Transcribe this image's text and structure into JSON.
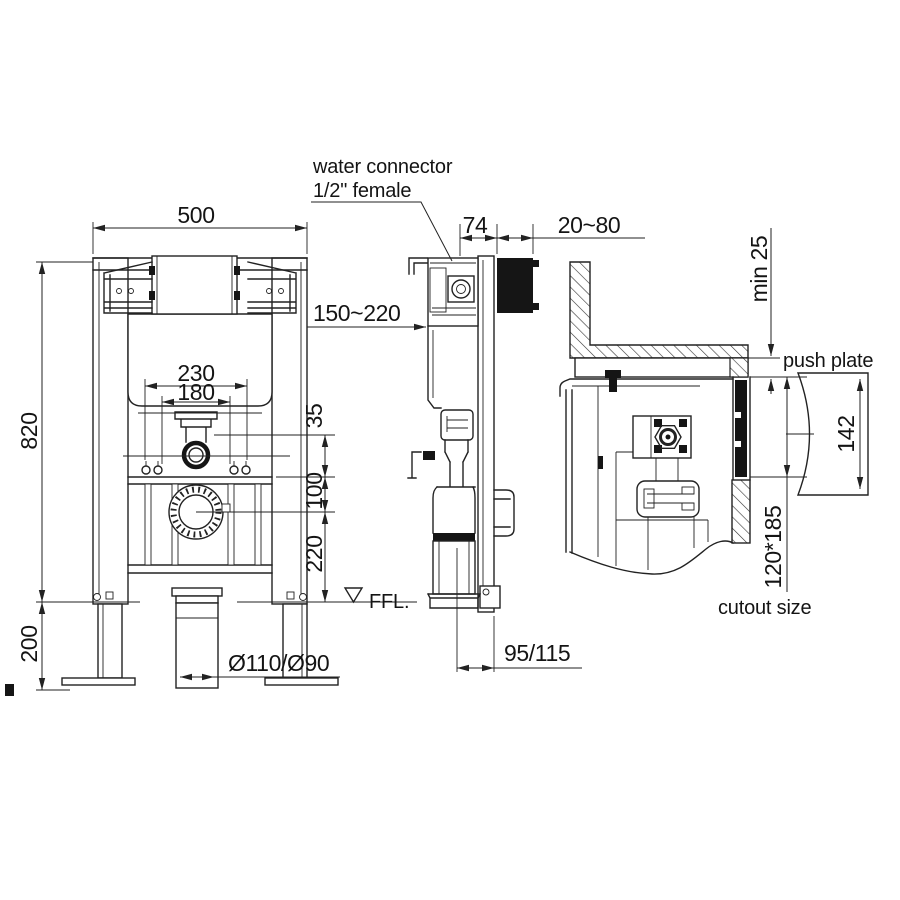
{
  "drawing": {
    "type": "technical-installation-diagram",
    "subject": "concealed cistern wc frame, three views with dimensions",
    "colors": {
      "line": "#222222",
      "background": "#ffffff",
      "solid_fill": "#151515"
    },
    "labels": {
      "water_connector_line1": "water connector",
      "water_connector_line2": "1/2\" female",
      "push_plate": "push plate",
      "cutout_size": "cutout size",
      "ffl": "FFL."
    },
    "dimensions": {
      "frame_width": "500",
      "frame_height": "820",
      "floor_zone": "200",
      "bracket_span": "230",
      "bolt_span": "180",
      "offset_35": "35",
      "offset_100": "100",
      "outlet_height": "220",
      "drain_diameters": "Ø110/Ø90",
      "depth_74": "74",
      "wall_gap": "20~80",
      "inlet_range": "150~220",
      "outlet_offset": "95/115",
      "min_wall": "min 25",
      "plate_height": "142",
      "cutout_dims": "120*185"
    }
  }
}
